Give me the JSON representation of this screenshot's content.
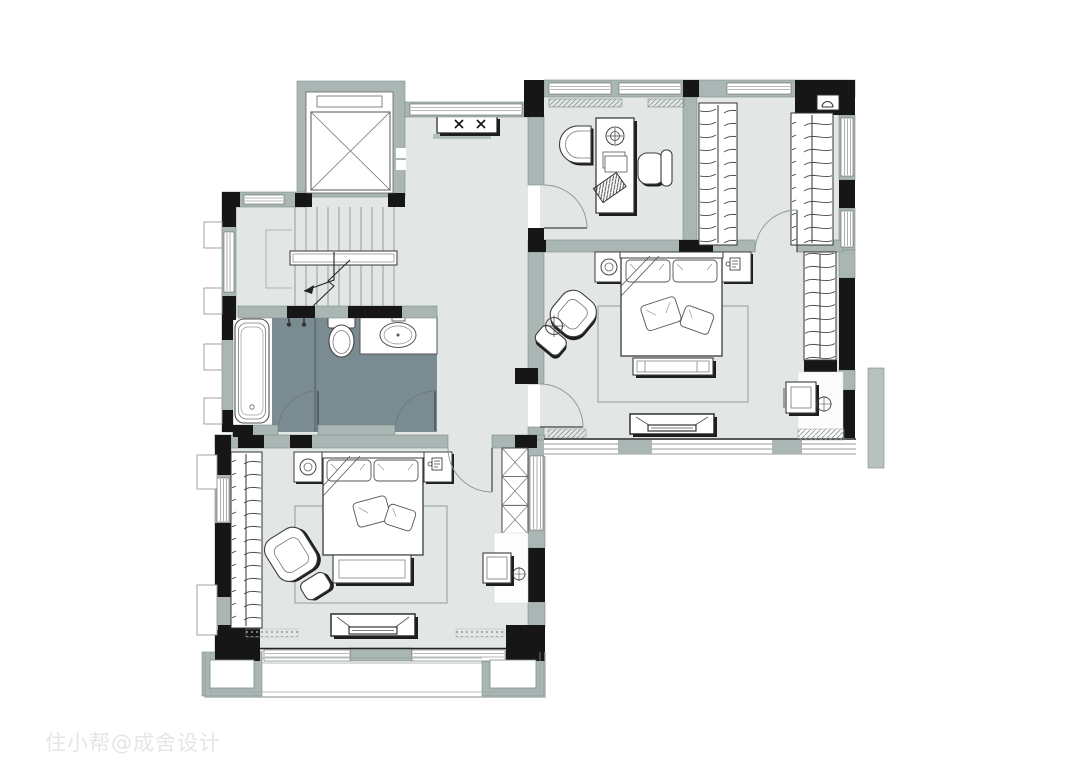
{
  "watermark": {
    "text": "住小帮@成舍设计"
  },
  "palette": {
    "background": "#ffffff",
    "floor": "#e2e7e5",
    "wall_light": "#a9b6b4",
    "wall_dark": "#161616",
    "bathroom_floor": "#7b8b92",
    "furniture_stroke": "#3c3c3c",
    "shadow": "#1d1d1d",
    "rug_outline": "#9aa5a3",
    "watermark_color": "#e7e5e3"
  },
  "plan": {
    "type": "residential-floor-plan",
    "areas": [
      {
        "name": "elevator-shaft",
        "features": [
          "elevator-cab-cross"
        ]
      },
      {
        "name": "stair-hall",
        "features": [
          "staircase",
          "center-handrail",
          "direction-arrow",
          "console-table"
        ]
      },
      {
        "name": "bathroom",
        "features": [
          "bathtub",
          "toilet",
          "vanity-sink",
          "shower-heads",
          "two-doors"
        ]
      },
      {
        "name": "study",
        "features": [
          "desk",
          "desk-lamp",
          "lounge-chair",
          "office-chair",
          "door"
        ]
      },
      {
        "name": "walk-in-closet",
        "features": [
          "wardrobe-left",
          "wardrobe-right",
          "pendant-lamp",
          "door"
        ]
      },
      {
        "name": "master-bedroom",
        "features": [
          "double-bed",
          "pillows",
          "nightstand-left",
          "nightstand-right",
          "table-lamp",
          "telephone",
          "foot-bench",
          "armchair",
          "ottoman",
          "floor-lamp",
          "rug",
          "tv-cabinet",
          "wardrobe",
          "dressing-table",
          "stool",
          "door",
          "window-wall"
        ]
      },
      {
        "name": "second-bedroom",
        "features": [
          "double-bed",
          "pillows",
          "nightstand-left",
          "nightstand-right",
          "table-lamp",
          "telephone",
          "foot-bench",
          "armchair",
          "ottoman",
          "rug",
          "tv-cabinet",
          "wardrobe",
          "x-storage-cabinet",
          "desk",
          "stool",
          "door",
          "window-wall"
        ]
      },
      {
        "name": "balcony",
        "features": [
          "planter-left",
          "planter-right",
          "railing"
        ]
      }
    ]
  }
}
